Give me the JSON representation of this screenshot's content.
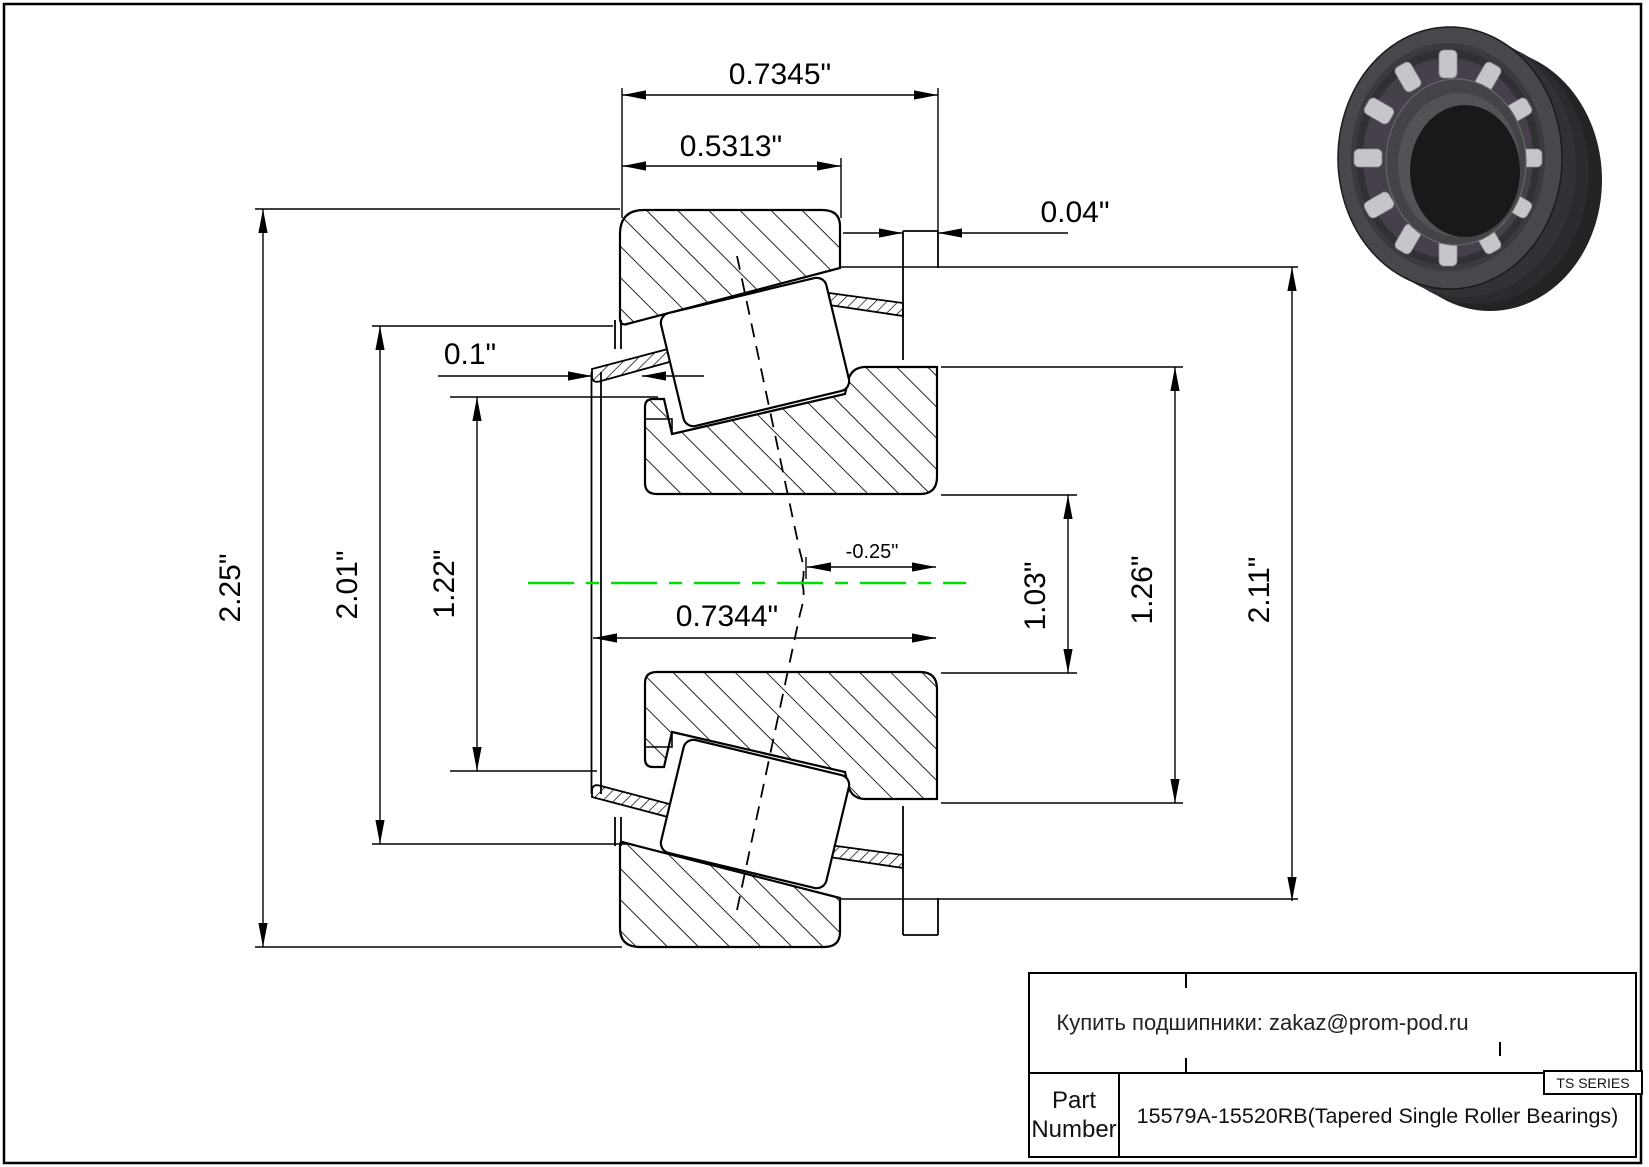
{
  "drawing": {
    "dimensions": {
      "total_width": "0.7345\"",
      "cup_width": "0.5313\"",
      "stand_out": "0.04\"",
      "lip_width": "0.1\"",
      "outer_diameter": "2.25\"",
      "race_diameter": "2.01\"",
      "cage_diameter": "1.22\"",
      "bore_width": "0.7344\"",
      "center_offset": "-0.25\"",
      "inner_diameter": "1.03\"",
      "rib_diameter": "1.26\"",
      "flange_diameter": "2.11\""
    },
    "centerline_color": "#00dd00"
  },
  "title_block": {
    "contact_line": "Купить подшипники: zakaz@prom-pod.ru",
    "series_label": "TS SERIES",
    "part_label": "Part Number",
    "part_value": "15579A-15520RB(Tapered Single Roller Bearings)"
  }
}
